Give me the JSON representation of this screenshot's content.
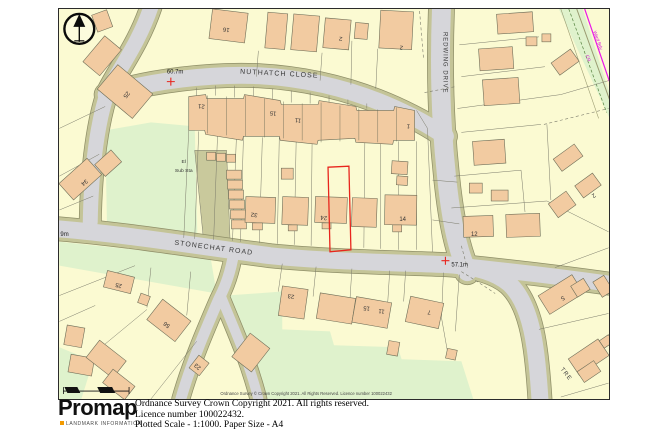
{
  "footer": {
    "brand": "Promap",
    "tagline": "LANDMARK INFORMATION",
    "accent_color": "#f39a00",
    "lines": [
      "Ordnance Survey Crown Copyright 2021. All rights reserved.",
      "Licence number 100022432.",
      "Plotted Scale - 1:1000. Paper Size - A4"
    ]
  },
  "map": {
    "copyright_inline": "Ordnance Survey © Crown Copyright 2021. All Rights Reserved. Licence number 100022432",
    "road_labels": [
      {
        "name": "NUTHATCH CLOSE"
      },
      {
        "name": "REDWING DRIVE"
      },
      {
        "name": "STONECHAT ROAD"
      },
      {
        "name": "TRE"
      }
    ],
    "labels": {
      "el1": "El",
      "el2": "Sub Sta",
      "ward_bdy": "Ward Bdy",
      "cr": "CR"
    },
    "spot_heights": [
      {
        "label": "60.7m"
      },
      {
        "label": "57.1m"
      },
      {
        "label": "9m"
      }
    ],
    "house_numbers": [
      {
        "label": "25"
      },
      {
        "label": "16"
      },
      {
        "label": "2"
      },
      {
        "label": "2"
      },
      {
        "label": "21"
      },
      {
        "label": "15"
      },
      {
        "label": "11"
      },
      {
        "label": "1"
      },
      {
        "label": "34"
      },
      {
        "label": "32"
      },
      {
        "label": "24"
      },
      {
        "label": "14"
      },
      {
        "label": "12"
      },
      {
        "label": "2"
      },
      {
        "label": "23"
      },
      {
        "label": "15"
      },
      {
        "label": "11"
      },
      {
        "label": "7"
      },
      {
        "label": "5"
      },
      {
        "label": "25"
      },
      {
        "label": "56"
      },
      {
        "label": "23"
      }
    ],
    "colors": {
      "plot_fill": "#fbfad2",
      "building_fill": "#f2cba1",
      "green_space": "#dff2cc",
      "road_surface": "#d6d6da",
      "road_verge": "#c4c497",
      "compound_fill": "#c9c99c",
      "selection_outline": "#e8251d",
      "boundary_line": "#e818e8"
    }
  }
}
